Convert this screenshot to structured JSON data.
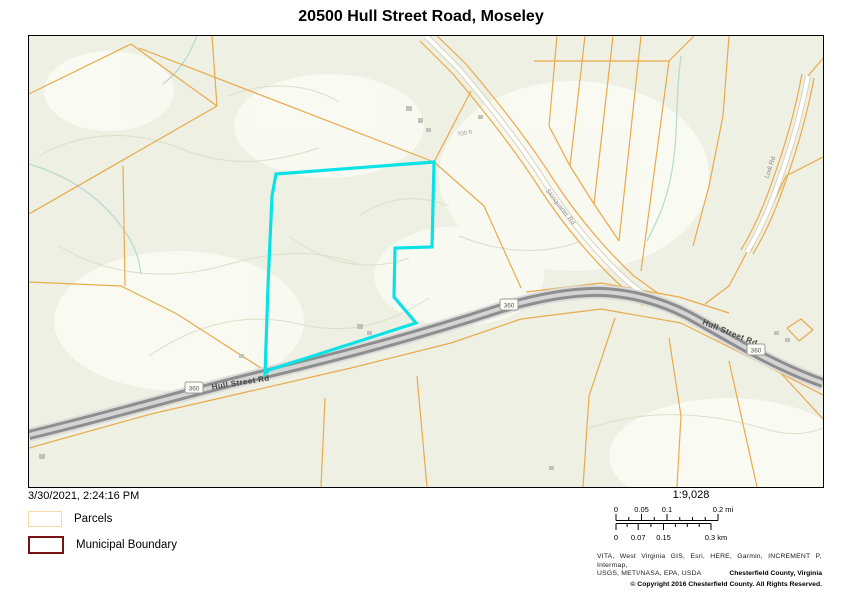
{
  "title": "20500 Hull Street Road, Moseley",
  "timestamp": "3/30/2021, 2:24:16 PM",
  "legend": {
    "items": [
      {
        "label": "Parcels"
      },
      {
        "label": "Municipal Boundary"
      }
    ]
  },
  "scale": {
    "ratio": "1:9,028",
    "miles_labels": [
      "0",
      "0.05",
      "0.1",
      "0.2 mi"
    ],
    "km_labels": [
      "0",
      "0.07",
      "0.15",
      "0.3 km"
    ]
  },
  "attribution": {
    "line1": "VITA, West Virginia GIS, Esri, HERE, Garmin, INCREMENT P, Intermap,",
    "line2": "USGS, METI/NASA, EPA, USDA"
  },
  "credits": {
    "org": "Chesterfield County, Virginia",
    "copyright": "© Copyright 2016 Chesterfield County. All Rights Reserved."
  },
  "map": {
    "labels": {
      "highway_left": "Hull Street Rd",
      "highway_right": "Hull Street Rd",
      "route_shield": "360",
      "cross_road": "Skinquarter Rd",
      "side_road": "Lodi Rd",
      "spot_elevation": "700 ft"
    },
    "colors": {
      "parcel_line": "#eaaa4c",
      "legend_parcel_border": "#f6d9a6",
      "municipal_boundary": "#7a1214",
      "highlight_parcel": "#0be2e6",
      "map_background": "#edf0e2",
      "road_casing": "#8e8e8e",
      "road_fill": "#dcdcdc"
    }
  }
}
